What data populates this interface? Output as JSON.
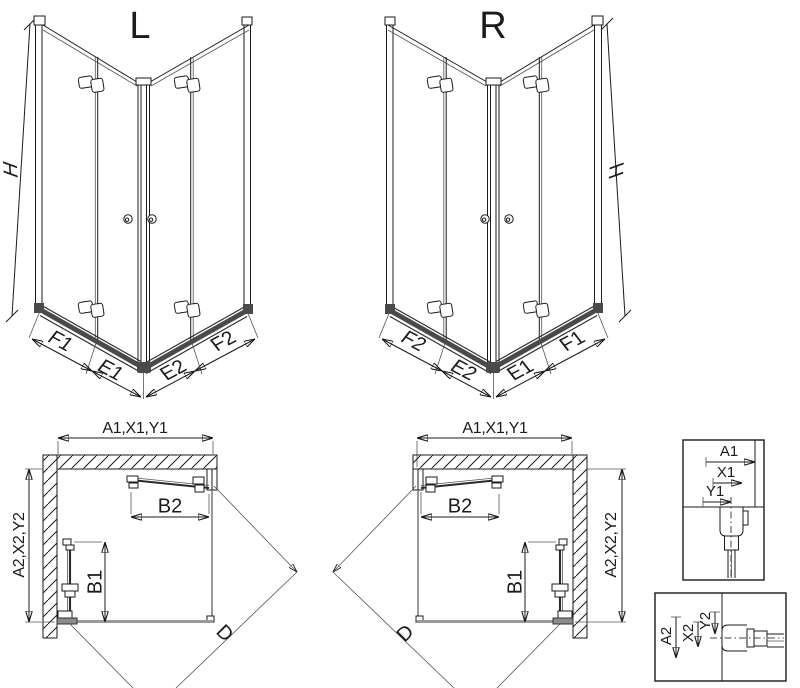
{
  "figure": {
    "views": {
      "perspective_left": {
        "title": "L",
        "height_dim": "H",
        "bottom_dims": {
          "f1": "F1",
          "e1": "E1",
          "e2": "E2",
          "f2": "F2"
        }
      },
      "perspective_right": {
        "title": "R",
        "height_dim": "H",
        "bottom_dims": {
          "f2": "F2",
          "e2": "E2",
          "e1": "E1",
          "f1": "F1"
        }
      },
      "plan_left": {
        "width_dim": "A1,X1,Y1",
        "depth_dim": "A2,X2,Y2",
        "entry_top_dim": "B2",
        "entry_side_dim": "B1",
        "diagonal_dim": "D"
      },
      "plan_right": {
        "width_dim": "A1,X1,Y1",
        "depth_dim": "A2,X2,Y2",
        "entry_top_dim": "B2",
        "entry_side_dim": "B1",
        "diagonal_dim": "D"
      },
      "detail_width_profile": {
        "dims": [
          "A1",
          "X1",
          "Y1"
        ]
      },
      "detail_depth_profile": {
        "dims": [
          "A2",
          "X2",
          "Y2"
        ]
      }
    },
    "colors": {
      "line": "#1b1b1b",
      "rail": "#4a4a4a",
      "glass_edge": "#8b8b8b",
      "background": "#ffffff"
    }
  }
}
